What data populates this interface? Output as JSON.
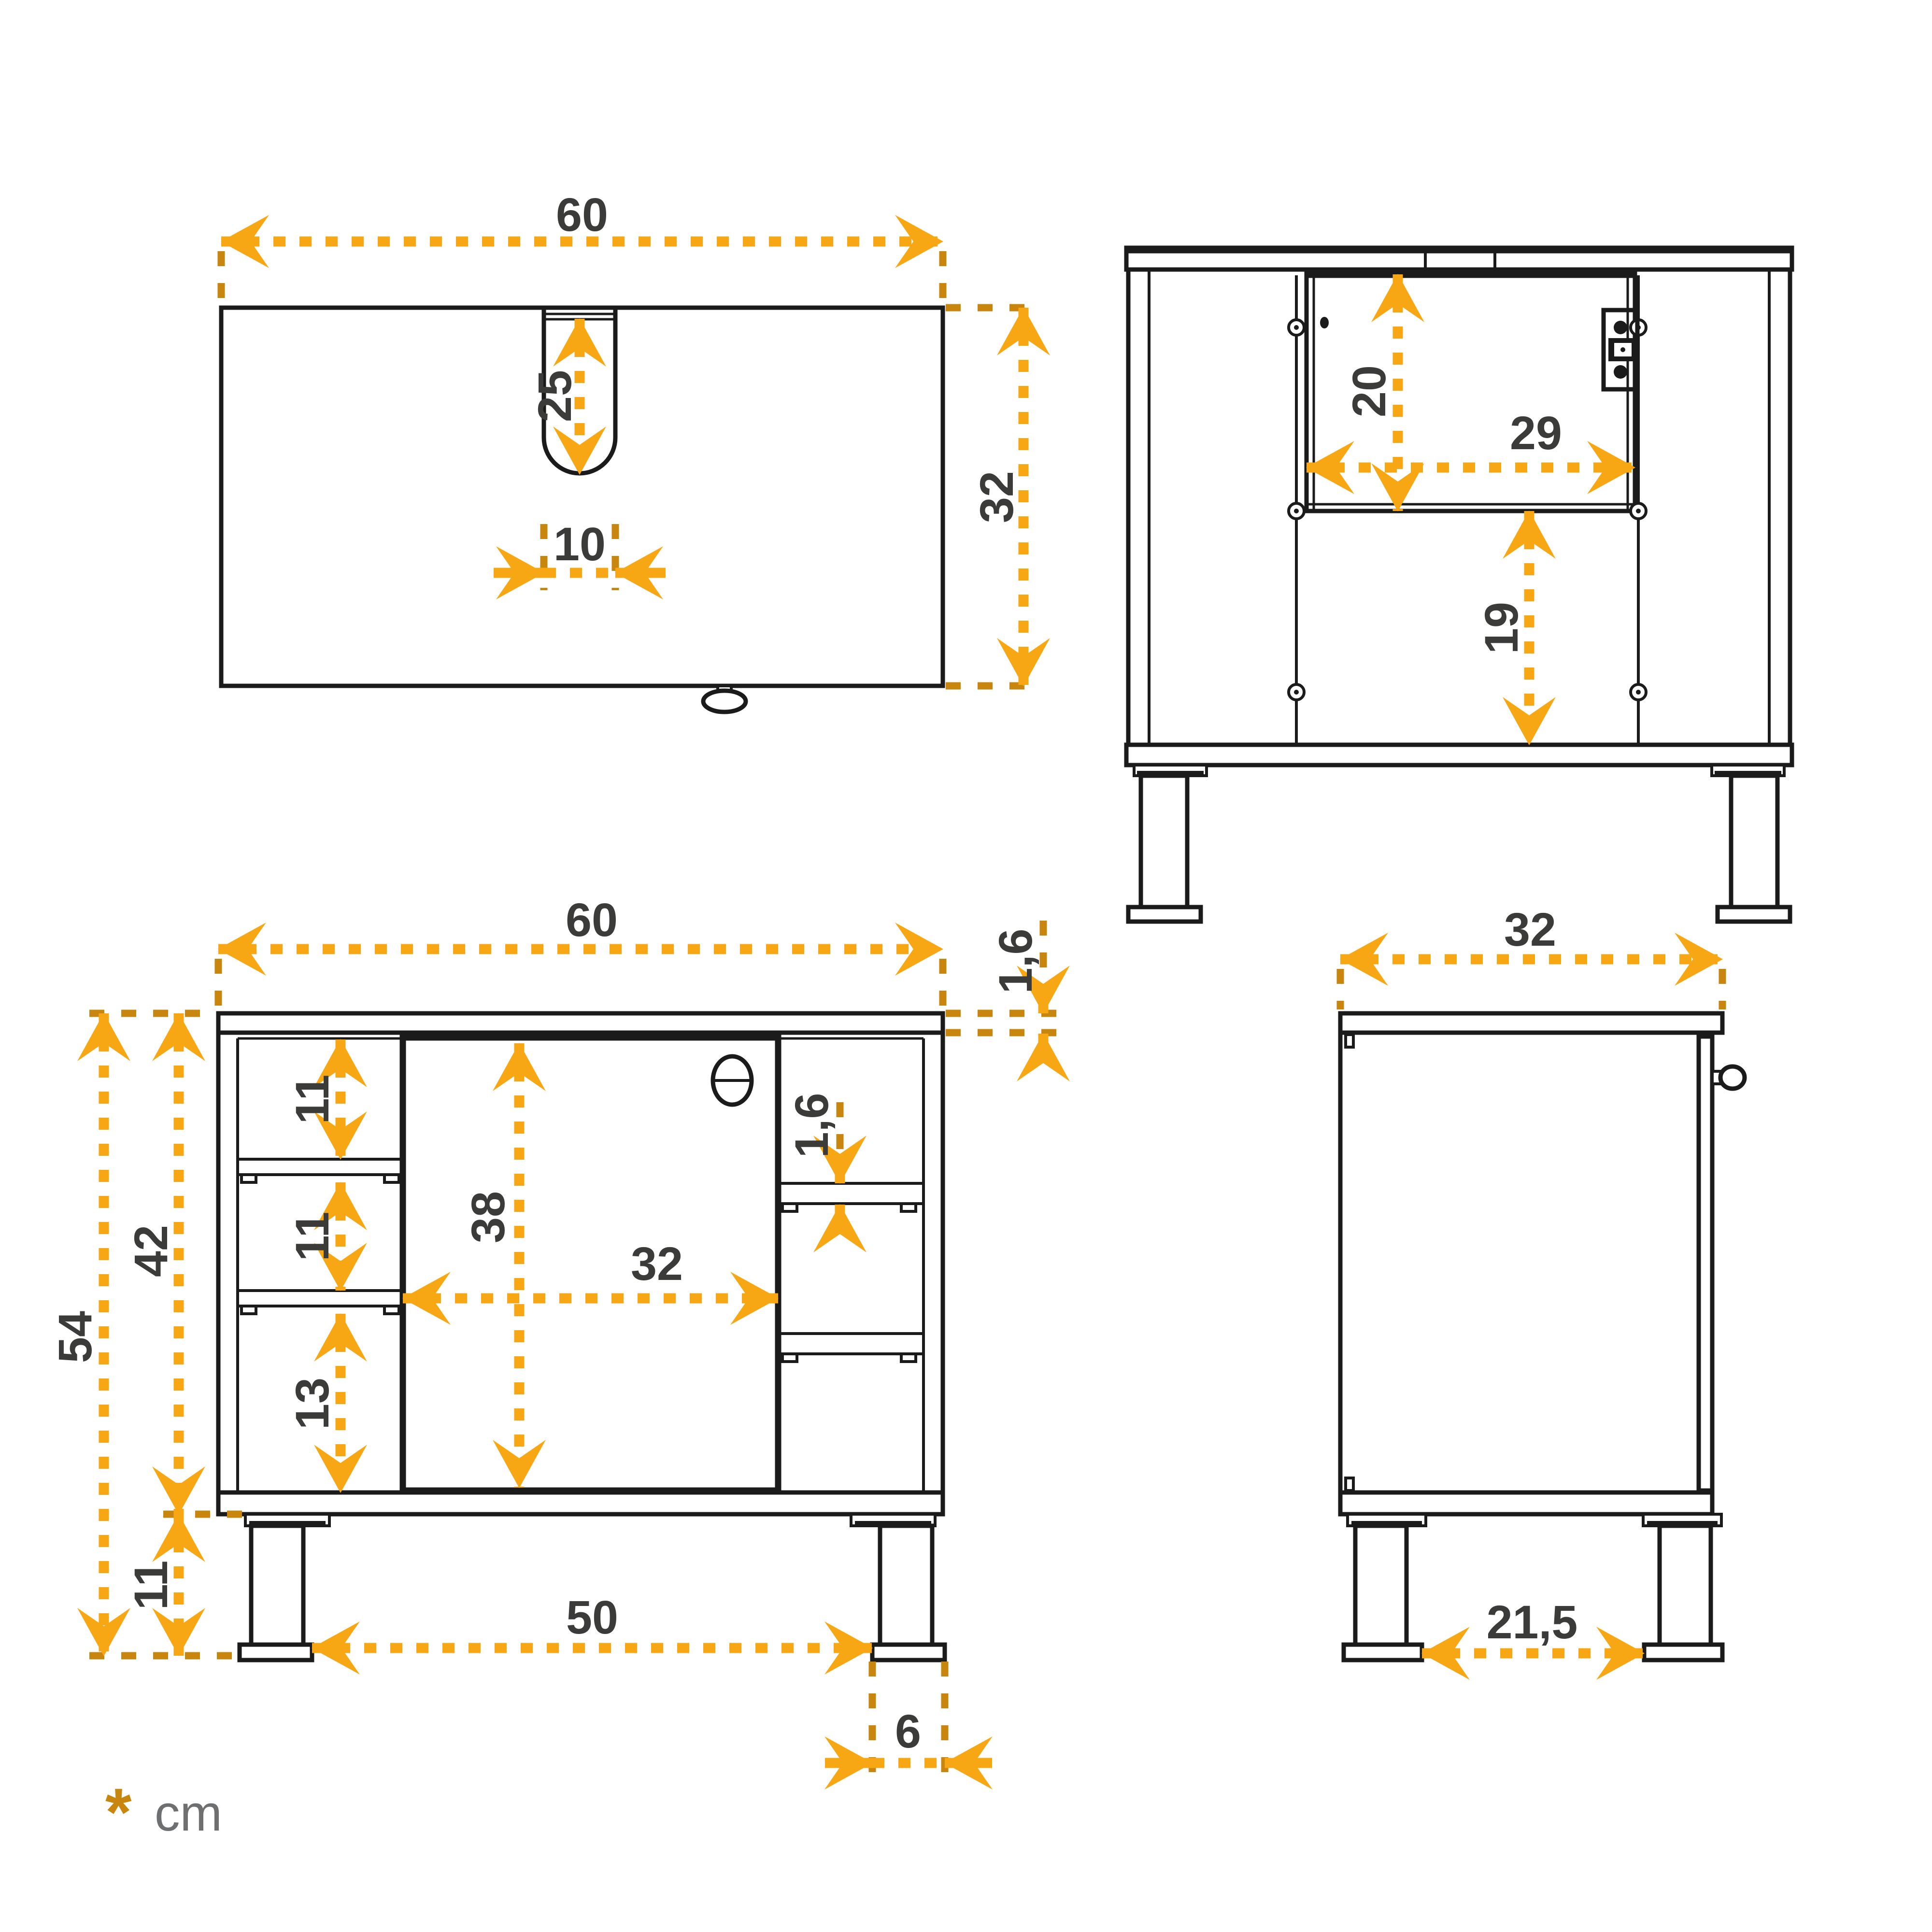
{
  "legend": {
    "symbol": "*",
    "unit": "cm"
  },
  "views": {
    "top": {
      "width": "60",
      "slot_depth": "25",
      "slot_width": "10",
      "depth": "32"
    },
    "back": {
      "opening_height": "20",
      "opening_width": "29",
      "lower_height": "19"
    },
    "front": {
      "width": "60",
      "top_thickness": "1,6",
      "compartment_1": "11",
      "compartment_2": "11",
      "compartment_3": "13",
      "body_height": "42",
      "total_height": "54",
      "door_height": "38",
      "door_width": "32",
      "shelf_thickness": "1,6",
      "leg_height": "11",
      "feet_distance": "50",
      "foot_width": "6"
    },
    "side": {
      "depth": "32",
      "feet_distance": "21,5"
    }
  },
  "colors": {
    "dimension": "#F7A713",
    "extension": "#C9860E",
    "label": "#3B3B3A",
    "line": "#1B1B1B"
  }
}
